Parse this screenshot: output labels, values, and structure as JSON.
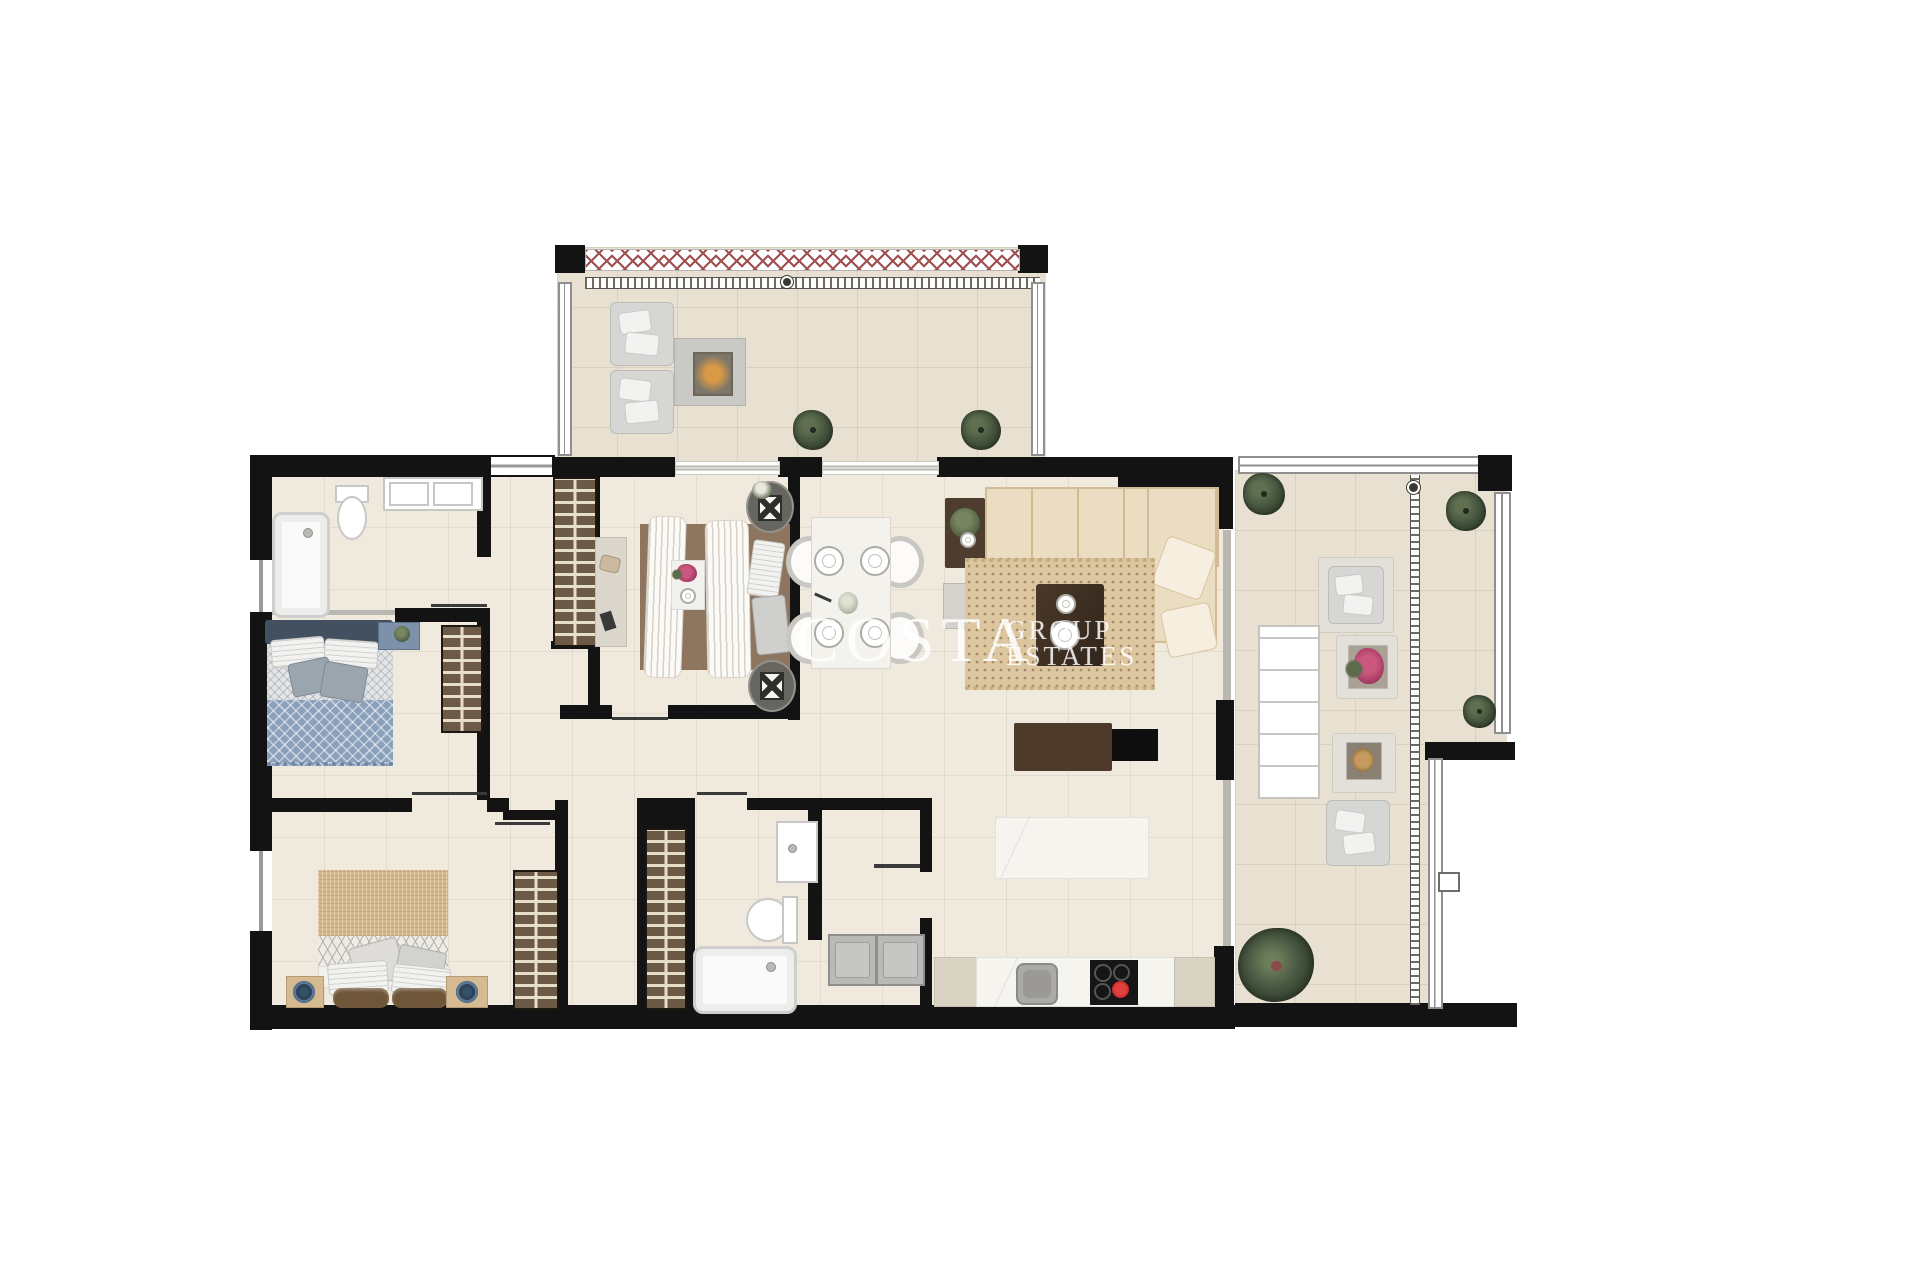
{
  "image_type": "real-estate apartment floor plan rendering, top-down view, no room labels",
  "watermark": {
    "line1": "COSTA",
    "line2": "GROUP",
    "line3": "ESTATES"
  },
  "palette": {
    "background": "#ffffff",
    "walls": "#131313",
    "interior_floor": "#efe9de",
    "terrace_floor": "#e8e1d2",
    "wardrobe_wood": "#6d5a46",
    "sofa_cream": "#ebddc1",
    "rug_beige": "#dcc6a0",
    "bed_blue": "#8ba0bb",
    "bed_tan": "#d7b68a",
    "balustrade_x": "#a04f4f",
    "hotplate_red": "#c01d20",
    "plant_green": "#41503a"
  },
  "floorplan": {
    "rooms": [
      {
        "name": "terrace-north",
        "furniture": [
          "lounge-chair",
          "lounge-chair",
          "fire-pit-table",
          "shrub-plant",
          "shrub-plant",
          "glass-balustrade",
          "pergola-track"
        ]
      },
      {
        "name": "bathroom-1",
        "furniture": [
          "bathtub",
          "toilet",
          "double-sink-vanity",
          "window"
        ]
      },
      {
        "name": "bedroom-2-blue",
        "furniture": [
          "double-bed-blue",
          "nightstand",
          "wardrobe",
          "window"
        ]
      },
      {
        "name": "bedroom-master",
        "furniture": [
          "double-bed-tan",
          "nightstand-left",
          "nightstand-right",
          "wardrobe",
          "window"
        ]
      },
      {
        "name": "bedroom-3-middle",
        "furniture": [
          "double-bed-white",
          "oval-nightstand-flowers",
          "oval-nightstand-lamp",
          "desk-console",
          "breakfast-tray"
        ]
      },
      {
        "name": "hallway",
        "furniture": [
          "built-in-wardrobe-north",
          "built-in-wardrobe-south"
        ]
      },
      {
        "name": "bathroom-2",
        "furniture": [
          "sink-vanity",
          "toilet",
          "bathtub"
        ]
      },
      {
        "name": "laundry-entry",
        "furniture": [
          "washer",
          "dryer"
        ]
      },
      {
        "name": "dining-area",
        "furniture": [
          "dining-table",
          "chair",
          "chair",
          "chair",
          "chair",
          "place-setting-x4",
          "centerpiece"
        ]
      },
      {
        "name": "living-room",
        "furniture": [
          "l-shaped-sofa",
          "throw-pillow",
          "throw-pillow",
          "side-table-plant",
          "gray-side-table",
          "area-rug",
          "coffee-table",
          "media-console-with-lamp",
          "tv-panel"
        ]
      },
      {
        "name": "kitchen",
        "furniture": [
          "island-marble",
          "counter-run",
          "sink",
          "induction-hob-one-zone-hot"
        ]
      },
      {
        "name": "terrace-east",
        "furniture": [
          "outdoor-sofa",
          "outdoor-armchair",
          "outdoor-armchair",
          "flower-table",
          "low-table",
          "shrub-plant",
          "shrub-plant",
          "shrub-plant",
          "large-potted-plant",
          "glass-balustrade",
          "track-strip",
          "wall-unit"
        ]
      }
    ]
  }
}
